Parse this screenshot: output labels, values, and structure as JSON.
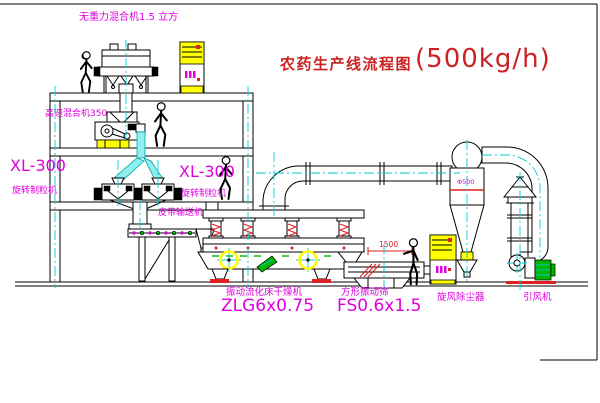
{
  "title": {
    "text": "农药生产线流程图",
    "capacity": "(500kg/h)"
  },
  "labels": {
    "gravity_mixer": "无重力混合机1.5 立方",
    "high_speed_mixer": "高速混合机350",
    "granulator_left_model": "XL-300",
    "granulator_left_name": "旋转制粒机",
    "granulator_right_model": "XL-300",
    "granulator_right_name": "旋转制粒机",
    "belt_conveyor": "皮带输送机",
    "dryer_name": "振动流化床干燥机",
    "dryer_model": "ZLG6x0.75",
    "sieve_name": "方形振动筛",
    "sieve_model": "FS0.6x1.5",
    "cyclone_name": "旋风除尘器",
    "fan_name": "引风机",
    "cyclone_size": "Φ500",
    "sieve_dim": "1500"
  },
  "colors": {
    "line": "#000000",
    "centerline": "#00d0d0",
    "label": "#e000e0",
    "title": "#cc2222",
    "highlight": "#ffff00",
    "accent_red": "#dd2222",
    "accent_green": "#00b400"
  }
}
